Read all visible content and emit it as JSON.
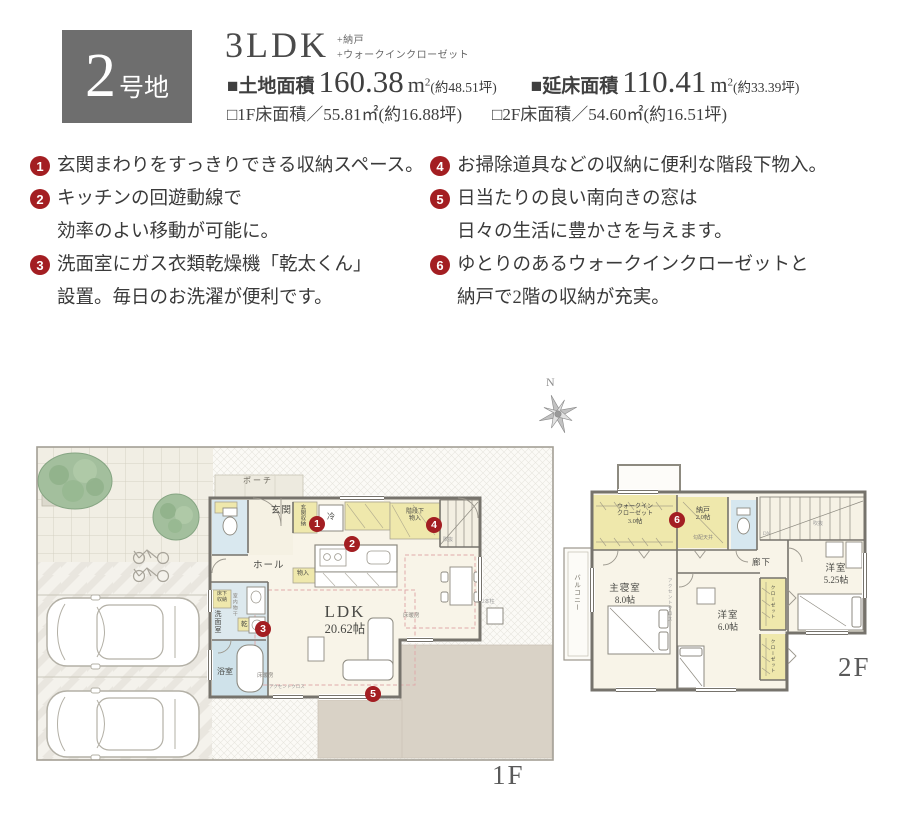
{
  "colors": {
    "accent_red": "#a31e22",
    "badge_gray": "#6e6e6e",
    "text_dark": "#3f3f3f",
    "room_cream": "#f8f4e8",
    "closet_yellow": "#efe8ac",
    "wet_area_blue": "#d6e7ef",
    "terrace_beige": "#d9d2c6",
    "tree_green": "#a3bf9d",
    "wall_gray": "#76736c",
    "floor_heating_pink": "#dfaaaa"
  },
  "header": {
    "lot_number": "2",
    "lot_suffix": "号地",
    "plan_type": "3LDK",
    "plan_extra1": "+納戸",
    "plan_extra2": "+ウォークインクローゼット",
    "land_bullet": "■",
    "land_label": "土地面積",
    "land_value": "160.38",
    "land_unit": "m",
    "land_unit_sup": "2",
    "land_tsubo": "(約48.51坪)",
    "total_bullet": "■",
    "total_label": "延床面積",
    "total_value": "110.41",
    "total_unit": "m",
    "total_unit_sup": "2",
    "total_tsubo": "(約33.39坪)",
    "sub1": "□1F床面積／55.81㎡(約16.88坪)",
    "sub2": "□2F床面積／54.60㎡(約16.51坪)"
  },
  "features": [
    {
      "num": "1",
      "lines": [
        "玄関まわりをすっきりできる収納スペース。"
      ]
    },
    {
      "num": "2",
      "lines": [
        "キッチンの回遊動線で",
        "効率のよい移動が可能に。"
      ]
    },
    {
      "num": "3",
      "lines": [
        "洗面室にガス衣類乾燥機「乾太くん」",
        "設置。毎日のお洗濯が便利です。"
      ]
    },
    {
      "num": "4",
      "lines": [
        "お掃除道具などの収納に便利な階段下物入。"
      ]
    },
    {
      "num": "5",
      "lines": [
        "日当たりの良い南向きの窓は",
        "日々の生活に豊かさを与えます。"
      ]
    },
    {
      "num": "6",
      "lines": [
        "ゆとりのあるウォークインクローゼットと",
        "納戸で2階の収納が充実。"
      ]
    }
  ],
  "compass": {
    "north": "N"
  },
  "floor1": {
    "tag": "1F",
    "labels": {
      "porch": "ポーチ",
      "entrance": "玄関",
      "entrance_storage": "玄関収納",
      "hall": "ホール",
      "fridge": "冷",
      "stair_storage_1": "階段下",
      "stair_storage_2": "物入",
      "storage": "物入",
      "underfloor_1": "床下",
      "underfloor_2": "収納",
      "washroom": "洗面室",
      "indoor_drying": "室内物干",
      "dryer": "乾",
      "bathroom": "浴室",
      "ldk_name": "LDK",
      "ldk_size": "20.62帖",
      "floor_heating": "床暖房",
      "accent_cloth": "アクセントクロス",
      "void": "吹抜",
      "two_pillars": "2本柱"
    }
  },
  "floor2": {
    "tag": "2F",
    "labels": {
      "wic_1": "ウォークイン",
      "wic_2": "クローゼット",
      "wic_size": "3.0帖",
      "storeroom": "納戸",
      "storeroom_size": "2.0帖",
      "sloped_ceiling": "勾配天井",
      "down": "DN",
      "void": "吹抜",
      "corridor": "廊下",
      "bedroom2": "洋室",
      "bedroom2_size": "5.25帖",
      "master": "主寝室",
      "master_size": "8.0帖",
      "bedroom3": "洋室",
      "bedroom3_size": "6.0帖",
      "balcony": "バルコニー",
      "closet": "クローゼット",
      "accent_cloth": "アクセントクロス"
    }
  }
}
